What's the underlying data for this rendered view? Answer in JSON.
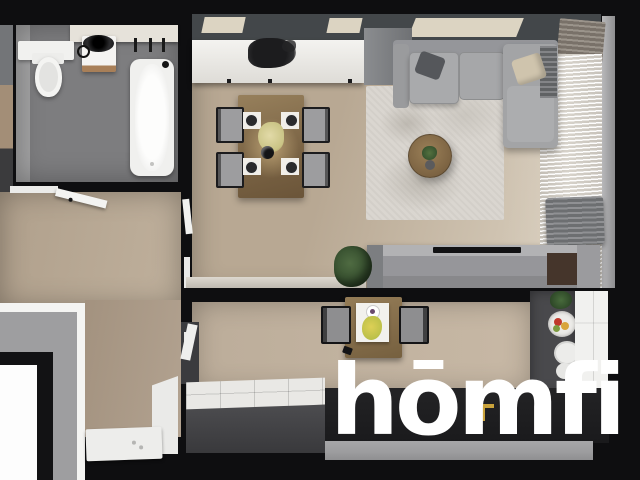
{
  "image": {
    "type": "3d-apartment-floorplan-render",
    "description": "Top-down dollhouse 3D render of an apartment interior with black cut walls on a black background",
    "view": "bird's-eye"
  },
  "watermark": {
    "text": "hōmfi",
    "placement": "bottom-right",
    "color": "#ffffff"
  },
  "scene": {
    "rooms": [
      {
        "name": "Bathroom",
        "position": "top-left",
        "objects": [
          "bathtub",
          "toilet",
          "white vanity with round black sink",
          "marble counter",
          "black wall faucets",
          "white shelf",
          "gray tile floor"
        ]
      },
      {
        "name": "Hallway",
        "position": "left",
        "objects": [
          "open white doors",
          "wood plank floor",
          "door frames"
        ]
      },
      {
        "name": "Dining room",
        "position": "top-center",
        "objects": [
          "wooden dining table",
          "four gray chairs",
          "white sideboard",
          "dark decorative plant",
          "black pendant lamp",
          "yellow table flowers",
          "four place settings",
          "wall bench",
          "ceiling light panels"
        ]
      },
      {
        "name": "Living room",
        "position": "top-right",
        "objects": [
          "gray corner sofa",
          "dark gray pillow",
          "beige pillow",
          "textured light rug",
          "round wooden coffee table with plant",
          "TV sideboard",
          "green plant",
          "gray armchair",
          "sheer curtains",
          "dark drapes"
        ]
      },
      {
        "name": "Kitchen",
        "position": "bottom-center",
        "objects": [
          "small wooden table",
          "two black chairs",
          "white tray with yellow flowers",
          "white tiled counter",
          "dark counter with fruit bowl and plates",
          "white cabinets",
          "black island with gold faucet",
          "dark fridge"
        ]
      },
      {
        "name": "Entry / utility",
        "position": "bottom-left",
        "objects": [
          "layered entry steps",
          "white shower tray",
          "white door panel"
        ]
      }
    ]
  },
  "colors": {
    "background": "#0e0e10",
    "wall_band": "#43474a",
    "skylight": "#dcd4c2",
    "bath_tile": "#7d7d7f",
    "bath_tile_light": "#a2a2a3",
    "marble": "#e6e2da",
    "white_furniture": "#f2f1ee",
    "wood_hall": "#b2a18c",
    "wood_dining": "#b8a893",
    "wood_living": "#cfc3b1",
    "wood_kitchen": "#c0b19e",
    "table_wood": "#8a7050",
    "chair_gray": "#9d9d9f",
    "sofa": "#a5a6a8",
    "pillow_dark": "#55575b",
    "pillow_beige": "#cfc4ad",
    "rug": "#dad6d0",
    "coffee_table": "#8c7351",
    "plant_green": "#3c5737",
    "tv_cabinet": "#96969a",
    "tv_brown": "#45352b",
    "curtain": "#d6d1c9",
    "drape": "#6d6f72",
    "drape_tan": "#8a8177",
    "counter_dark": "#49494c",
    "island_black": "#202022",
    "tile_counter": "#e9e8e5",
    "cut_gray": "#9c9c9e",
    "faucet_gold": "#c9a23b",
    "logo": "#ffffff"
  }
}
